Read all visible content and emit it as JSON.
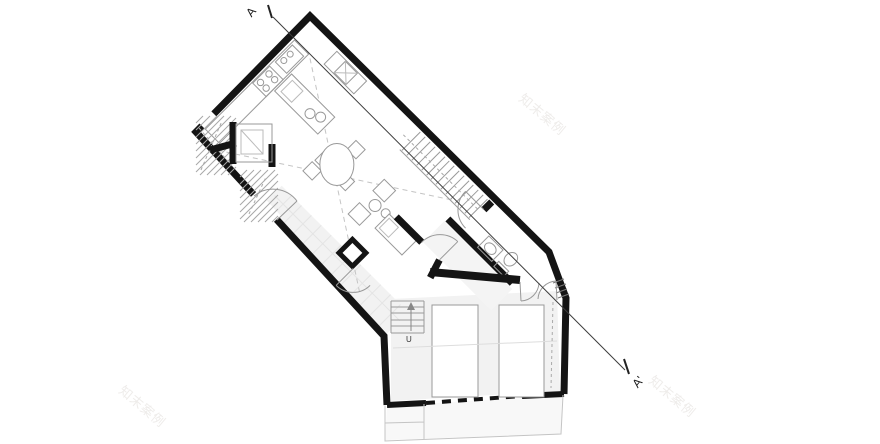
{
  "drawing": {
    "kind": "architectural floor plan with section line",
    "section_line": {
      "start_label": "A",
      "end_label": "A'"
    },
    "stairs": {
      "up_label": "U"
    },
    "watermark": {
      "text": "知末案例",
      "count": 3
    },
    "colors": {
      "background": "#ffffff",
      "wall": "#141414",
      "furniture_line": "#999999",
      "floor_tint": "#f2f2f2",
      "terrace_tint": "#f8f8f8",
      "dashed_guides": "#c4c4c4",
      "section_line": "#3c3c3c",
      "watermark": "#eeecea"
    }
  }
}
